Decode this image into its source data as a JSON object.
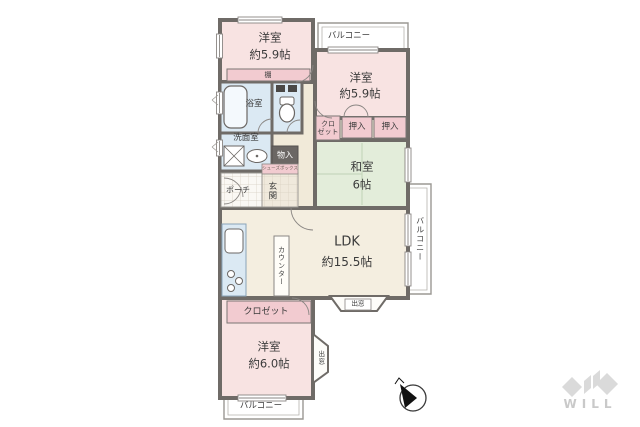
{
  "plan": {
    "rooms": {
      "bedroom_nw": {
        "name": "洋室",
        "size": "約5.9帖"
      },
      "bedroom_ne": {
        "name": "洋室",
        "size": "約5.9帖"
      },
      "japanese_room": {
        "name": "和室",
        "size": "6帖"
      },
      "ldk": {
        "name": "LDK",
        "size": "約15.5帖"
      },
      "bedroom_s": {
        "name": "洋室",
        "size": "約6.0帖"
      },
      "bathroom": {
        "label": "浴室"
      },
      "washroom": {
        "label": "洗面室"
      },
      "entrance": {
        "label": "玄関"
      },
      "porch": {
        "label": "ポーチ"
      }
    },
    "storage": {
      "shelf": "棚",
      "closet_north": {
        "line1": "クロ",
        "line2": "ゼット"
      },
      "oshiire_1": "押入",
      "oshiire_2": "押入",
      "monoire": "物入",
      "shoe_box": "シューズボックス",
      "closet_south": "クロゼット",
      "counter": "カウンター"
    },
    "bay_windows": {
      "ldk": "出窓",
      "south": "出窓"
    },
    "balconies": {
      "top": "バルコニー",
      "right": "バルコニー",
      "bottom": "バルコニー"
    }
  },
  "footer": {
    "logo": "WILL"
  },
  "colors": {
    "room_pink": "#f8e3e2",
    "tatami_green": "#e3edda",
    "ldk_cream": "#f4eee0",
    "wet_area_blue": "#dbe9f3",
    "label_pink": "#f2cbd0",
    "wall": "#6f6b67",
    "logo_gray": "#dadada"
  }
}
